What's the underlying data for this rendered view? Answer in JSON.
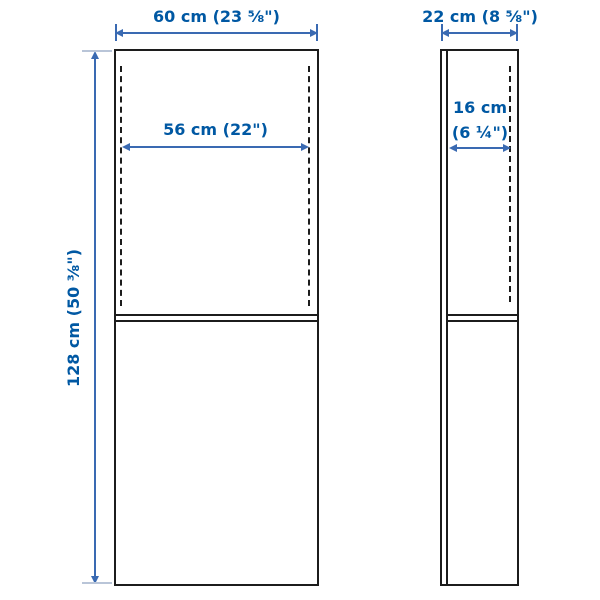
{
  "diagram": {
    "type": "furniture-dimension-diagram",
    "views": [
      "front",
      "side"
    ],
    "front_view": {
      "width": "60 cm (23 ⅝\")",
      "inner_width": "56 cm (22\")",
      "height": "128 cm (50 ⅜\")"
    },
    "side_view": {
      "depth": "22 cm (8 ⅝\")",
      "inner_depth_line1": "16 cm",
      "inner_depth_line2": "(6 ¼\")"
    },
    "colors": {
      "dimension_text": "#0058a3",
      "dimension_line": "#3a6ab2",
      "product_outline": "#1c1c1c",
      "extension_tick": "#b9c5d8",
      "background": "#ffffff"
    }
  }
}
